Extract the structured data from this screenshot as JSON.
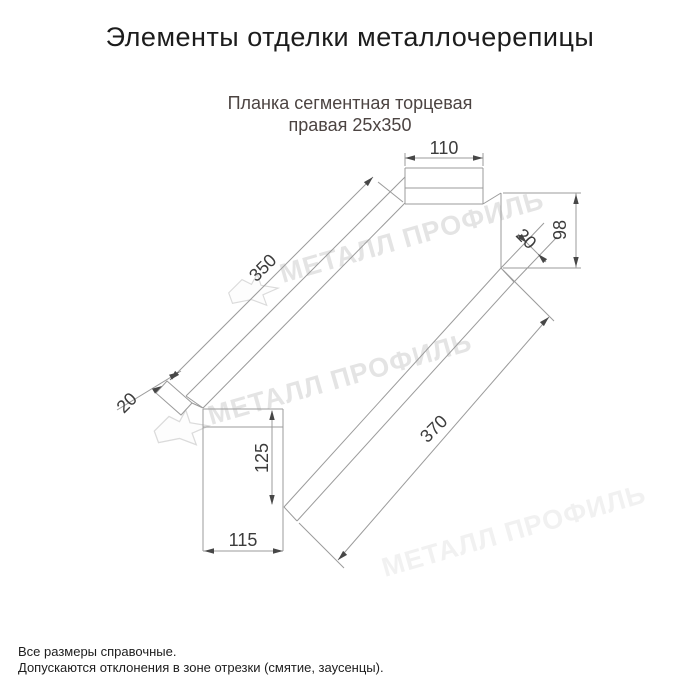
{
  "page": {
    "title": "Элементы отделки металлочерепицы",
    "product": {
      "line1": "Планка сегментная торцевая",
      "line2": "правая 25x350"
    },
    "notes": [
      "Все размеры справочные.",
      "Допускаются отклонения в зоне отрезки (смятие, заусенцы)."
    ]
  },
  "drawing": {
    "watermark": "МЕТАЛЛ ПРОФИЛЬ",
    "dimensions": {
      "top_width": "110",
      "main_length": "350",
      "right_height": "98",
      "right_hem": "20",
      "left_hem": "20",
      "face_height": "125",
      "face_width": "115",
      "bottom_length": "370"
    },
    "colors": {
      "line": "#9b9b9b",
      "dim_text": "#3c3c3c",
      "watermark": "#e4e4e4",
      "watermark_faint": "#f1f1f1",
      "subtitle": "#4c4442"
    }
  }
}
